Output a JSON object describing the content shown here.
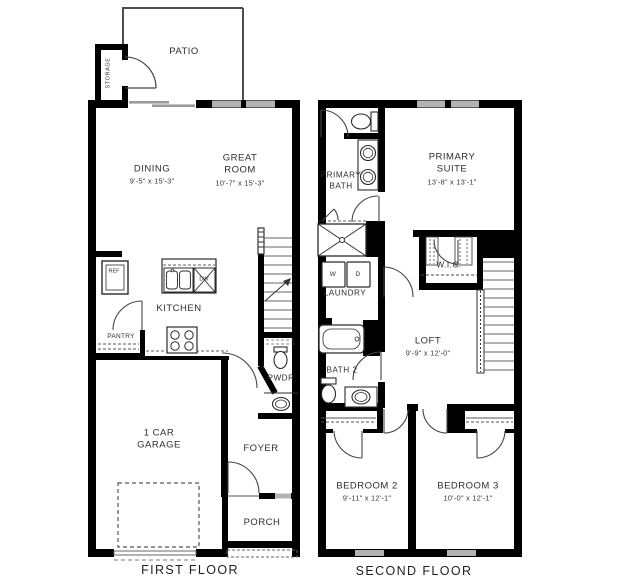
{
  "colors": {
    "wall": "#000000",
    "window_fill": "#b3b3b3",
    "line_gray": "#555555",
    "text": "#2e2e2e"
  },
  "first_floor": {
    "title": "FIRST FLOOR",
    "rooms": {
      "patio": {
        "label": "PATIO"
      },
      "storage": {
        "label": "STORAGE"
      },
      "dining": {
        "label": "DINING",
        "dims": "9'-5\" x 15'-3\""
      },
      "great_room": {
        "label": "GREAT ROOM",
        "dims": "10'-7\" x 15'-3\""
      },
      "kitchen": {
        "label": "KITCHEN"
      },
      "pantry": {
        "label": "PANTRY"
      },
      "pwdr": {
        "label": "PWDR"
      },
      "garage": {
        "label": "1 CAR GARAGE"
      },
      "foyer": {
        "label": "FOYER"
      },
      "porch": {
        "label": "PORCH"
      }
    },
    "fixtures": {
      "ref": "REF",
      "dw": "DW"
    }
  },
  "second_floor": {
    "title": "SECOND FLOOR",
    "rooms": {
      "primary_bath": {
        "label": "PRIMARY BATH"
      },
      "primary_suite": {
        "label": "PRIMARY SUITE",
        "dims": "13'-8\" x 13'-1\""
      },
      "wic": {
        "label": "W.I.C."
      },
      "laundry": {
        "label": "LAUNDRY"
      },
      "loft": {
        "label": "LOFT",
        "dims": "9'-9\" x 12'-0\""
      },
      "bath2": {
        "label": "BATH 2"
      },
      "bedroom2": {
        "label": "BEDROOM 2",
        "dims": "9'-11\" x 12'-1\""
      },
      "bedroom3": {
        "label": "BEDROOM 3",
        "dims": "10'-0\" x 12'-1\""
      }
    },
    "fixtures": {
      "washer": "W",
      "dryer": "D"
    }
  }
}
